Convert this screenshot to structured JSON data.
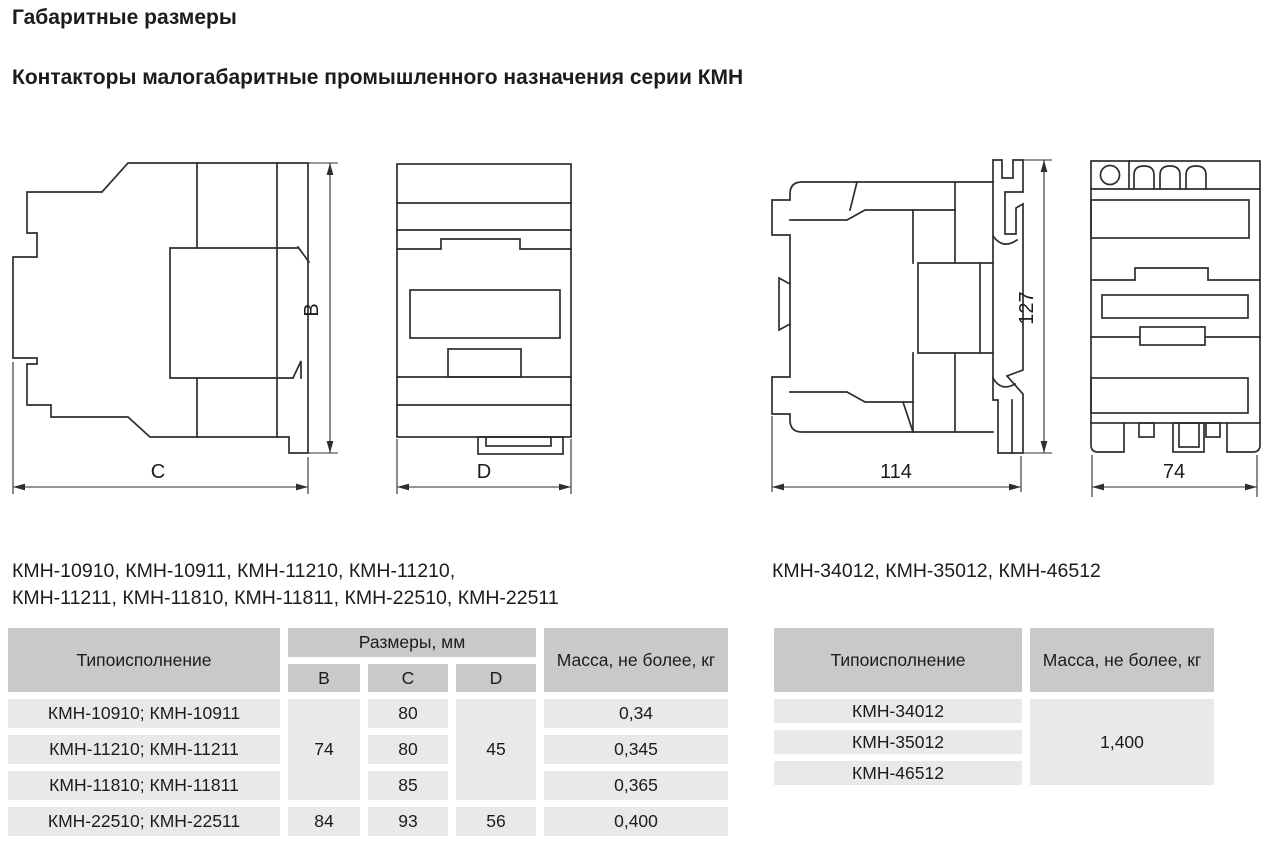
{
  "theme": {
    "header_bg": "#c9c9c9",
    "row_bg": "#e9e9e9",
    "text_color": "#1c1c1c",
    "line_color": "#2e2e2e"
  },
  "page": {
    "title": "Габаритные размеры",
    "subtitle": "Контакторы малогабаритные промышленного назначения серии КМН"
  },
  "drawings": {
    "small": {
      "dim_height": "B",
      "dim_depth": "C",
      "dim_width": "D"
    },
    "large": {
      "dim_height": "127",
      "dim_depth": "114",
      "dim_width": "74"
    }
  },
  "left_group": {
    "models_line1": "КМН-10910, КМН-10911, КМН-11210, КМН-11210,",
    "models_line2": "КМН-11211, КМН-11810, КМН-11811, КМН-22510, КМН-22511",
    "table": {
      "col_type": "Типоисполнение",
      "col_dims": "Размеры, мм",
      "col_b": "B",
      "col_c": "C",
      "col_d": "D",
      "col_mass": "Масса, не более, кг",
      "merged_b": "74",
      "merged_d": "45",
      "rows": [
        {
          "type": "КМН-10910; КМН-10911",
          "c": "80",
          "mass": "0,34"
        },
        {
          "type": "КМН-11210; КМН-11211",
          "c": "80",
          "mass": "0,345"
        },
        {
          "type": "КМН-11810; КМН-11811",
          "c": "85",
          "mass": "0,365"
        },
        {
          "type": "КМН-22510; КМН-22511",
          "b": "84",
          "c": "93",
          "d": "56",
          "mass": "0,400"
        }
      ]
    }
  },
  "right_group": {
    "models_line1": "КМН-34012, КМН-35012, КМН-46512",
    "table": {
      "col_type": "Типоисполнение",
      "col_mass": "Масса, не более, кг",
      "merged_mass": "1,400",
      "rows": [
        {
          "type": "КМН-34012"
        },
        {
          "type": "КМН-35012"
        },
        {
          "type": "КМН-46512"
        }
      ]
    }
  }
}
